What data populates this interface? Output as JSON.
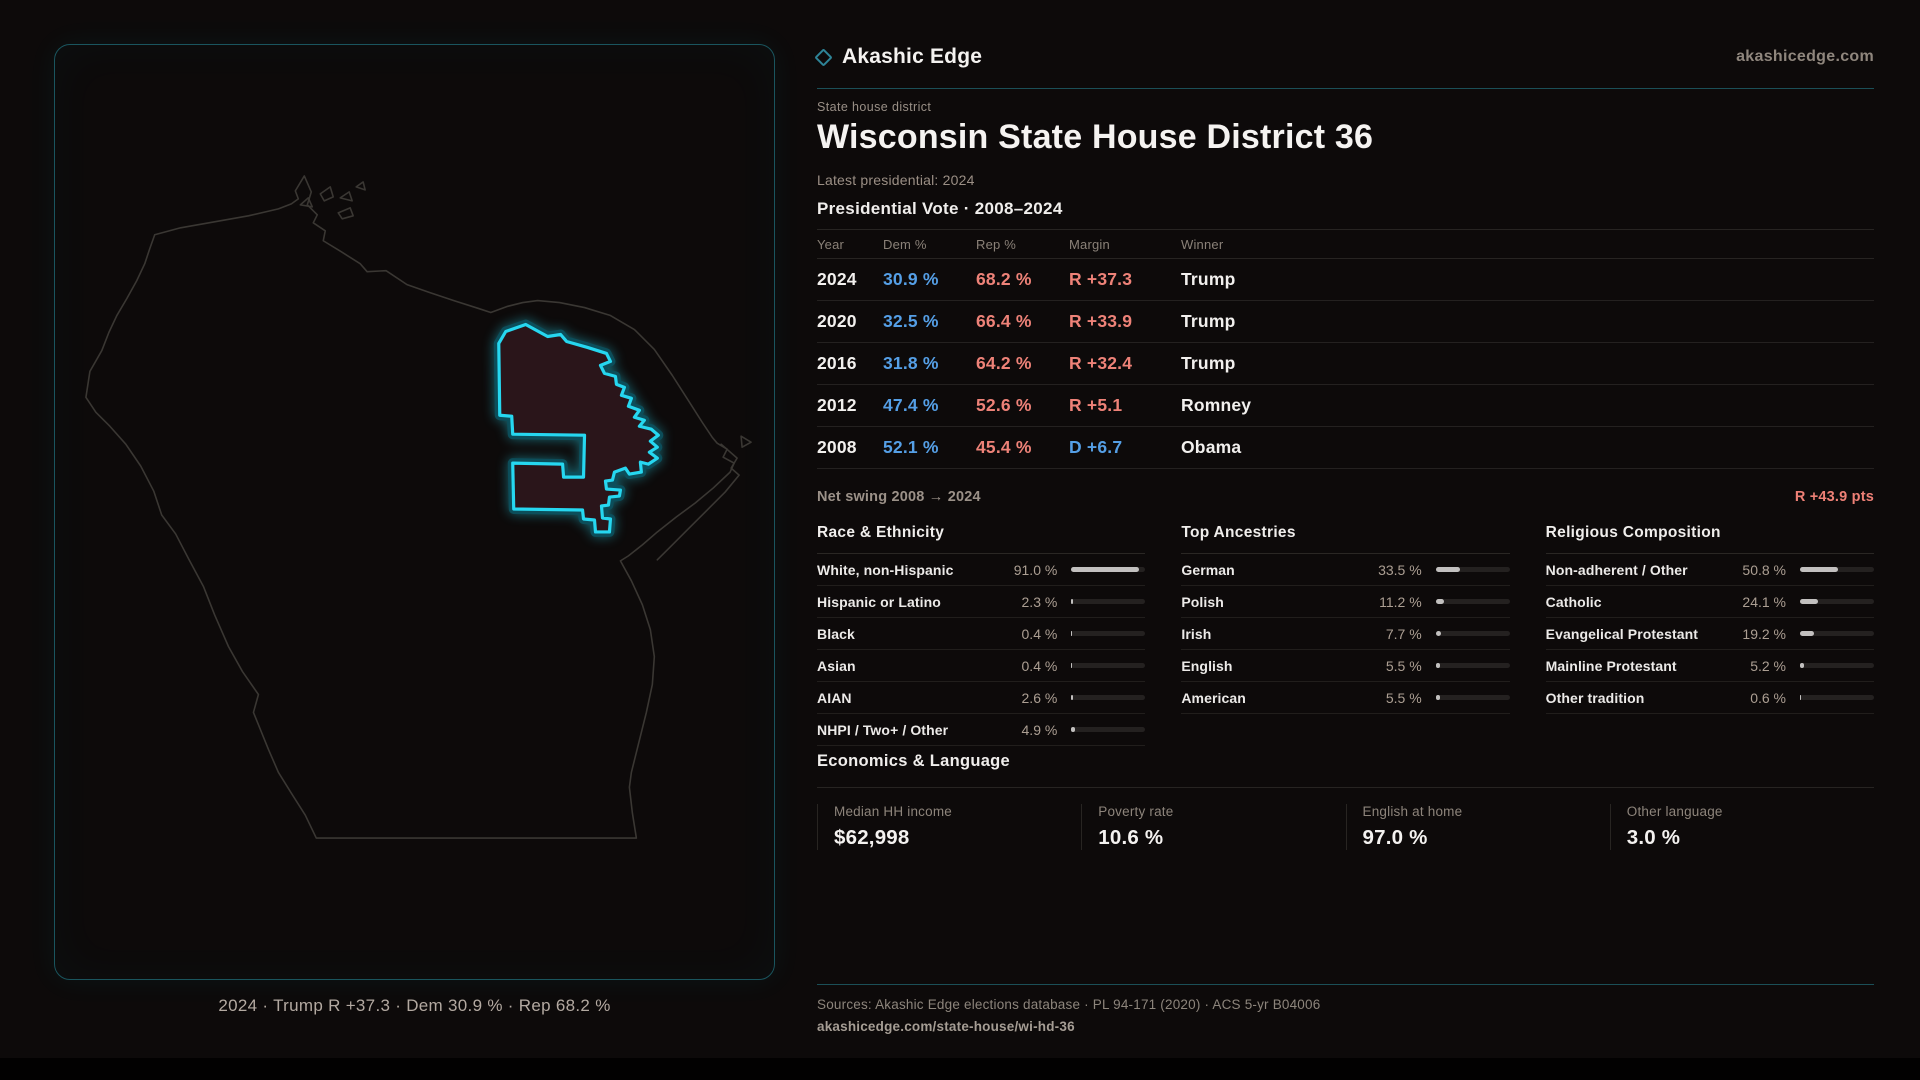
{
  "colors": {
    "accent_cyan": "#26d7f0",
    "dem_blue": "#559fe6",
    "rep_red": "#ee8278",
    "teal_rule": "#1b4f57",
    "district_fill": "#2a151a",
    "bar_fill": "#c2c0bf"
  },
  "brand": {
    "icon": "diamond-icon",
    "name": "Akashic Edge",
    "site": "akashicedge.com"
  },
  "header": {
    "eyebrow": "State house district",
    "title": "Wisconsin State House District 36",
    "latest": "Latest presidential: 2024"
  },
  "net_swing": {
    "label": "Net swing 2008 → 2024",
    "value": "R +43.9 pts"
  },
  "chart_data": [
    {
      "type": "table",
      "title": "Presidential Vote · 2008–2024",
      "columns": [
        "Year",
        "Dem %",
        "Rep %",
        "Margin",
        "Winner"
      ],
      "rows": [
        [
          "2024",
          "30.9 %",
          "68.2 %",
          "R +37.3",
          "Trump"
        ],
        [
          "2020",
          "32.5 %",
          "66.4 %",
          "R +33.9",
          "Trump"
        ],
        [
          "2016",
          "31.8 %",
          "64.2 %",
          "R +32.4",
          "Trump"
        ],
        [
          "2012",
          "47.4 %",
          "52.6 %",
          "R +5.1",
          "Romney"
        ],
        [
          "2008",
          "52.1 %",
          "45.4 %",
          "D +6.7",
          "Obama"
        ]
      ]
    },
    {
      "type": "bar",
      "title": "Race & Ethnicity",
      "categories": [
        "White, non-Hispanic",
        "Hispanic or Latino",
        "Black",
        "Asian",
        "AIAN",
        "NHPI / Two+ / Other"
      ],
      "values": [
        91.0,
        2.3,
        0.4,
        0.4,
        2.6,
        4.9
      ],
      "unit": "%",
      "xlim": [
        0,
        100
      ],
      "orientation": "horizontal"
    },
    {
      "type": "bar",
      "title": "Top Ancestries",
      "categories": [
        "German",
        "Polish",
        "Irish",
        "English",
        "American"
      ],
      "values": [
        33.5,
        11.2,
        7.7,
        5.5,
        5.5
      ],
      "unit": "%",
      "xlim": [
        0,
        100
      ],
      "orientation": "horizontal"
    },
    {
      "type": "bar",
      "title": "Religious Composition",
      "categories": [
        "Non-adherent / Other",
        "Catholic",
        "Evangelical Protestant",
        "Mainline Protestant",
        "Other tradition"
      ],
      "values": [
        50.8,
        24.1,
        19.2,
        5.2,
        0.6
      ],
      "unit": "%",
      "xlim": [
        0,
        100
      ],
      "orientation": "horizontal"
    }
  ],
  "economics": {
    "title": "Economics & Language",
    "stats": [
      {
        "label": "Median HH income",
        "value": "$62,998"
      },
      {
        "label": "Poverty rate",
        "value": "10.6 %"
      },
      {
        "label": "English at home",
        "value": "97.0 %"
      },
      {
        "label": "Other language",
        "value": "3.0 %"
      }
    ]
  },
  "map": {
    "caption": "2024 · Trump R +37.3 · Dem 30.9 % · Rep 68.2 %"
  },
  "footer": {
    "sources": "Sources: Akashic Edge elections database · PL 94-171 (2020) · ACS 5-yr B04006",
    "link": "akashicedge.com/state-house/wi-hd-36"
  }
}
